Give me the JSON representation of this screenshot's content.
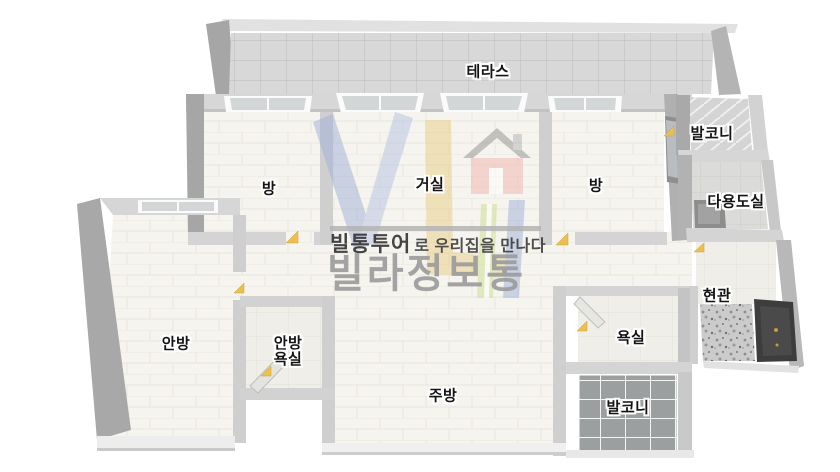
{
  "watermark": {
    "tagline_bold": "빌통투어",
    "tagline_rest": "로 우리집을 만나다",
    "brand": "빌라정보통"
  },
  "rooms": {
    "terrace": {
      "label": "테라스"
    },
    "balcony_top": {
      "label": "발코니"
    },
    "utility": {
      "label": "다용도실"
    },
    "room_left": {
      "label": "방"
    },
    "living": {
      "label": "거실"
    },
    "room_right": {
      "label": "방"
    },
    "entrance": {
      "label": "현관"
    },
    "master": {
      "label": "안방"
    },
    "master_bath": {
      "label_line1": "안방",
      "label_line2": "욕실"
    },
    "kitchen": {
      "label": "주방"
    },
    "bath": {
      "label": "욕실"
    },
    "balcony_bottom": {
      "label": "발코니"
    }
  },
  "colors": {
    "wall_light": "#d7d7d7",
    "wall_dark": "#a6a6a6",
    "floor_cream": "#f5f4ee",
    "terrace_gray": "#d8d8d8",
    "glass_gray": "#9c9fa0",
    "door_dark": "#3d3d3d",
    "door_knob_gold": "#c79a3a",
    "door_marker_yellow": "#ecbf4e",
    "brand_text_gray": "#9b9b9b",
    "logo_blue": "#9fb0d8",
    "logo_yellow": "#e9cd86",
    "logo_pink": "#f2b3ae",
    "logo_green": "#cddf90"
  }
}
